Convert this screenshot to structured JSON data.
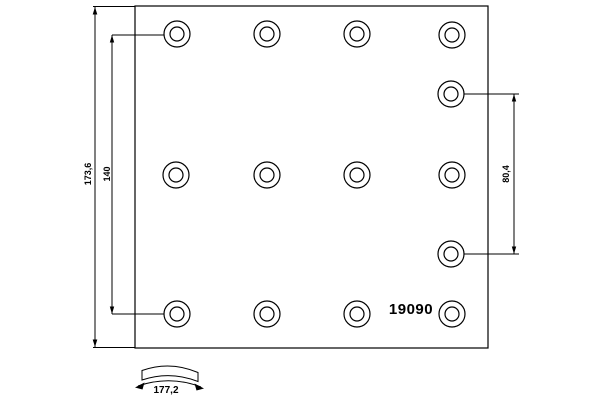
{
  "part_number": "19090",
  "labels": {
    "overall_height": "173,6",
    "rivet_span_left": "140",
    "rivet_span_right": "80,4",
    "arc_width": "177,2"
  },
  "colors": {
    "line": "#000000",
    "background": "#ffffff"
  },
  "drawing": {
    "plate": {
      "x": 135,
      "y": 6,
      "width": 353,
      "height": 342
    },
    "holes": {
      "outer_radius": 13,
      "inner_radius": 7,
      "centers": [
        [
          177,
          34
        ],
        [
          267,
          34
        ],
        [
          357,
          34
        ],
        [
          452,
          35
        ],
        [
          176,
          175
        ],
        [
          267,
          175
        ],
        [
          357,
          175
        ],
        [
          452,
          175
        ],
        [
          177,
          314
        ],
        [
          267,
          314
        ],
        [
          357,
          314
        ],
        [
          452,
          314
        ],
        [
          451,
          94
        ],
        [
          451,
          254
        ]
      ]
    },
    "dim_lines": {
      "overall_height_x": 95,
      "rivet_span_left_x": 112,
      "rivet_span_right_x": 514
    }
  }
}
